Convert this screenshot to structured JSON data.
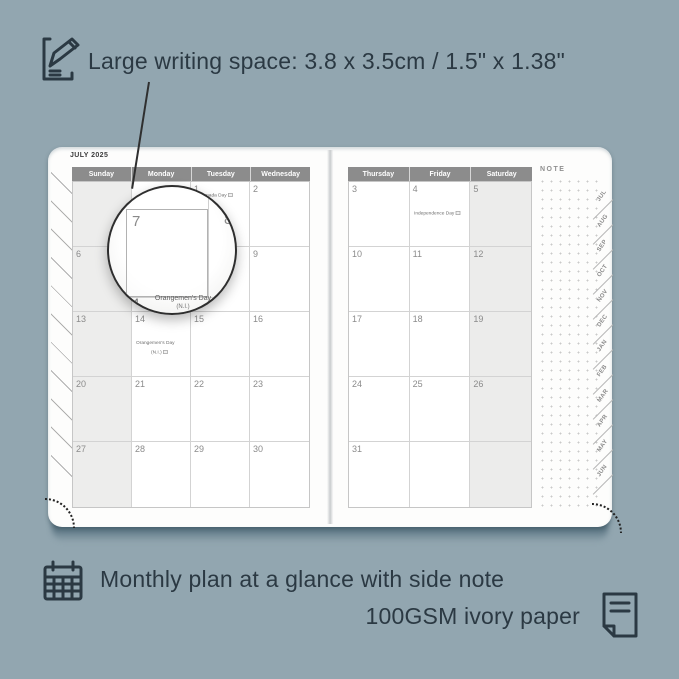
{
  "colors": {
    "background": "#92a6b0",
    "annotation_text": "#2b3943",
    "header_bar": "#8c8c8c",
    "weekend_shade": "#ededec",
    "page": "#fdfdfc"
  },
  "icons": {
    "top_left": "pencil-note-icon",
    "bottom_left": "calendar-grid-icon",
    "bottom_right": "paper-page-icon"
  },
  "top_annotation": {
    "text": "Large writing space: 3.8 x 3.5cm / 1.5\" x 1.38\""
  },
  "bottom_annotation": {
    "line1": "Monthly plan at a glance with side note",
    "line2": "100GSM ivory paper"
  },
  "planner": {
    "month_title": "JULY 2025",
    "note_label": "NOTE",
    "left_headers": [
      "Sunday",
      "Monday",
      "Tuesday",
      "Wednesday"
    ],
    "right_headers": [
      "Thursday",
      "Friday",
      "Saturday"
    ],
    "left_rows": [
      [
        {},
        {},
        {
          "d": "1",
          "h": "Canada Day",
          "hbox": true
        },
        {
          "d": "2"
        }
      ],
      [
        {
          "d": "6"
        },
        {
          "d": "7"
        },
        {
          "d": "8"
        },
        {
          "d": "9"
        }
      ],
      [
        {
          "d": "13"
        },
        {
          "d": "14",
          "h": "Orangemen's Day",
          "h2": "(N.I.)",
          "h2box": true
        },
        {
          "d": "15"
        },
        {
          "d": "16"
        }
      ],
      [
        {
          "d": "20"
        },
        {
          "d": "21"
        },
        {
          "d": "22"
        },
        {
          "d": "23"
        }
      ],
      [
        {
          "d": "27"
        },
        {
          "d": "28"
        },
        {
          "d": "29"
        },
        {
          "d": "30"
        }
      ]
    ],
    "right_rows": [
      [
        {
          "d": "3"
        },
        {
          "d": "4",
          "h": "Independence Day",
          "hbox": true
        },
        {
          "d": "5"
        }
      ],
      [
        {
          "d": "10"
        },
        {
          "d": "11"
        },
        {
          "d": "12"
        }
      ],
      [
        {
          "d": "17"
        },
        {
          "d": "18"
        },
        {
          "d": "19"
        }
      ],
      [
        {
          "d": "24"
        },
        {
          "d": "25"
        },
        {
          "d": "26"
        }
      ],
      [
        {
          "d": "31"
        },
        {},
        {}
      ]
    ],
    "tabs": [
      "JUL",
      "AUG",
      "SEP",
      "OCT",
      "NOV",
      "DEC",
      "JAN",
      "FEB",
      "MAR",
      "APR",
      "MAY",
      "JUN"
    ]
  },
  "magnifier": {
    "day_main": "7",
    "day_right": "8",
    "day_bottom": "14",
    "holiday": "Orangemen's Day",
    "holiday2": "(N.I.)"
  }
}
